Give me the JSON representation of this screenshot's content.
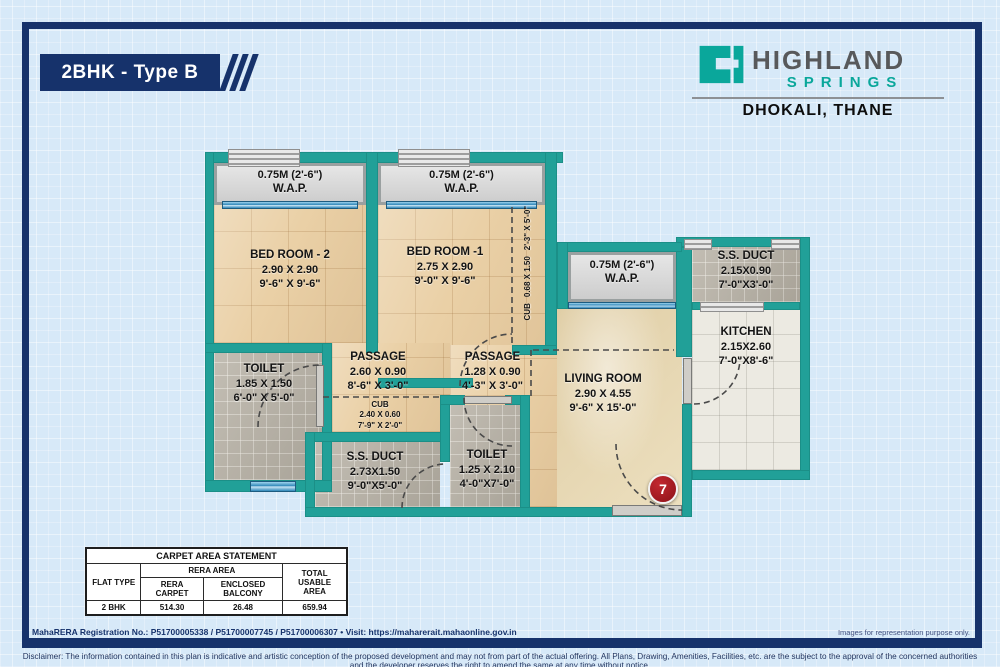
{
  "header": {
    "plan_title": "2BHK - Type B",
    "brand": {
      "name_top": "HIGHLAND",
      "name_bottom": "SPRINGS",
      "location": "DHOKALI, THANE"
    }
  },
  "colors": {
    "frame_navy": "#16326b",
    "wall_teal": "#21a098",
    "brand_teal": "#0aa79b",
    "brand_gray": "#58595b",
    "badge_red": "#8c1219"
  },
  "plan": {
    "waps": [
      {
        "dim": "0.75M (2'-6\")",
        "label": "W.A.P."
      },
      {
        "dim": "0.75M (2'-6\")",
        "label": "W.A.P."
      },
      {
        "dim": "0.75M (2'-6\")",
        "label": "W.A.P."
      }
    ],
    "rooms": {
      "bedroom2": {
        "name": "BED ROOM - 2",
        "m": "2.90 X 2.90",
        "ft": "9'-6\" X 9'-6\""
      },
      "bedroom1": {
        "name": "BED ROOM -1",
        "m": "2.75 X 2.90",
        "ft": "9'-0\" X 9'-6\""
      },
      "cub1": {
        "name": "CUB",
        "m": "0.68 X 1.50",
        "ft": "2'-3\" X 5'-0\""
      },
      "ssduct1": {
        "name": "S.S. DUCT",
        "m": "2.15X0.90",
        "ft": "7'-0\"X3'-0\""
      },
      "kitchen": {
        "name": "KITCHEN",
        "m": "2.15X2.60",
        "ft": "7'-0\"X8'-6\""
      },
      "living": {
        "name": "LIVING ROOM",
        "m": "2.90 X 4.55",
        "ft": "9'-6\" X 15'-0\""
      },
      "toilet1": {
        "name": "TOILET",
        "m": "1.85 X 1.50",
        "ft": "6'-0\" X 5'-0\""
      },
      "passage1": {
        "name": "PASSAGE",
        "m": "2.60 X 0.90",
        "ft": "8'-6\" X 3'-0\""
      },
      "cub2": {
        "name": "CUB",
        "m": "2.40 X 0.60",
        "ft": "7'-9\" X 2'-0\""
      },
      "passage2": {
        "name": "PASSAGE",
        "m": "1.28 X 0.90",
        "ft": "4'-3\" X 3'-0\""
      },
      "ssduct2": {
        "name": "S.S. DUCT",
        "m": "2.73X1.50",
        "ft": "9'-0\"X5'-0\""
      },
      "toilet2": {
        "name": "TOILET",
        "m": "1.25 X 2.10",
        "ft": "4'-0\"X7'-0\""
      }
    },
    "unit_number": "7"
  },
  "area_table": {
    "title": "CARPET AREA STATEMENT",
    "col_flat_type": "FLAT TYPE",
    "col_rera_area": "RERA AREA",
    "col_rera_carpet": "RERA CARPET",
    "col_enclosed_balcony": "ENCLOSED BALCONY",
    "col_total": "TOTAL USABLE AREA",
    "rows": [
      {
        "flat_type": "2 BHK",
        "rera_carpet": "514.30",
        "enclosed_balcony": "26.48",
        "total": "659.94"
      }
    ]
  },
  "footer": {
    "rera_line": "MahaRERA Registration No.:  P51700005338 / P51700007745 / P51700006307  • Visit: https://maharerait.mahaonline.gov.in",
    "images_note": "Images for representation purpose only.",
    "disclaimer": "Disclaimer: The information contained in this plan is indicative and artistic conception of the proposed development and may not from part of the actual offering. All Plans, Drawing, Amenities, Facilities, etc. are the subject to the approval of the concerned authorities and the developer reserves the right to amend the same at any time without notice."
  }
}
